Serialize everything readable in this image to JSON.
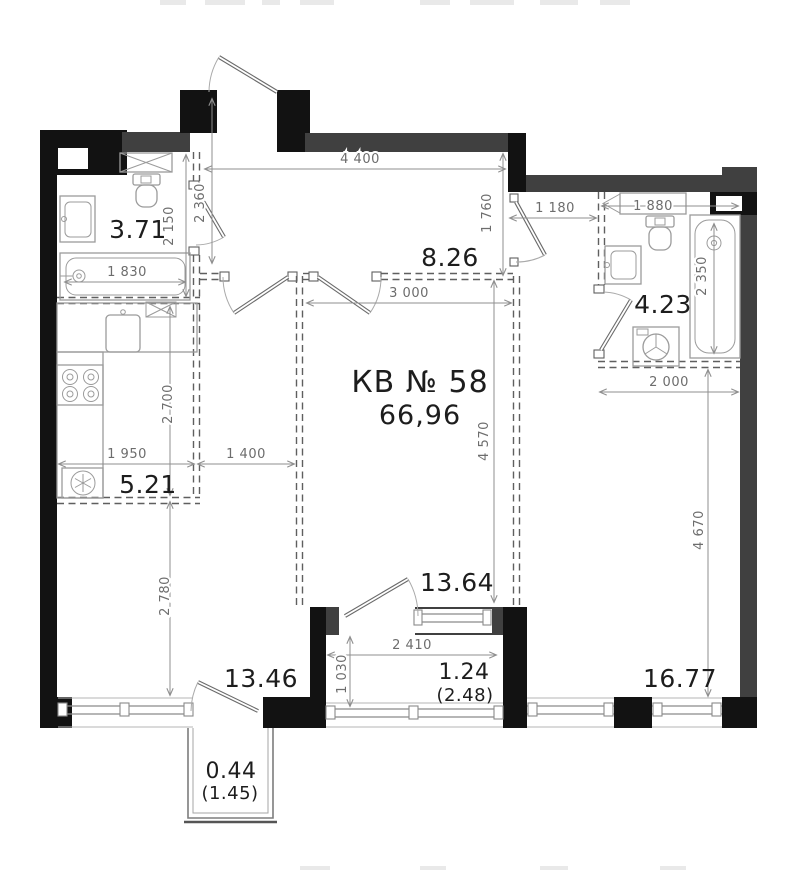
{
  "plan": {
    "title": "КВ № 58",
    "total_area": "66,96",
    "rooms": {
      "bath_left": "3.71",
      "hall": "8.26",
      "bath_right": "4.23",
      "kitchen": "5.21",
      "room_center": "13.64",
      "room_left": "13.46",
      "loggia": "1.24",
      "loggia_full": "(2.48)",
      "room_right": "16.77",
      "balcony": "0.44",
      "balcony_full": "(1.45)"
    },
    "dimensions": {
      "d4400": "4 400",
      "d2360": "2 360",
      "d2150": "2 150",
      "d1830": "1 830",
      "d1760": "1 760",
      "d1180": "1 180",
      "d1880": "1 880",
      "d2350": "2 350",
      "d3000": "3 000",
      "d2700": "2 700",
      "d1950": "1 950",
      "d1400": "1 400",
      "d4570": "4 570",
      "d2000": "2 000",
      "d2780": "2 780",
      "d4670": "4 670",
      "d2410": "2 410",
      "d1030": "1 030"
    },
    "colors": {
      "wall": "#404040",
      "wall_black": "#121212",
      "fixture": "#9b9b9b",
      "partition": "#5f5f5f",
      "window": "#8a8a8a",
      "dim_line": "#8f8f8f",
      "dim_text": "#6d6d6d",
      "label_text": "#1d1d1d"
    }
  }
}
